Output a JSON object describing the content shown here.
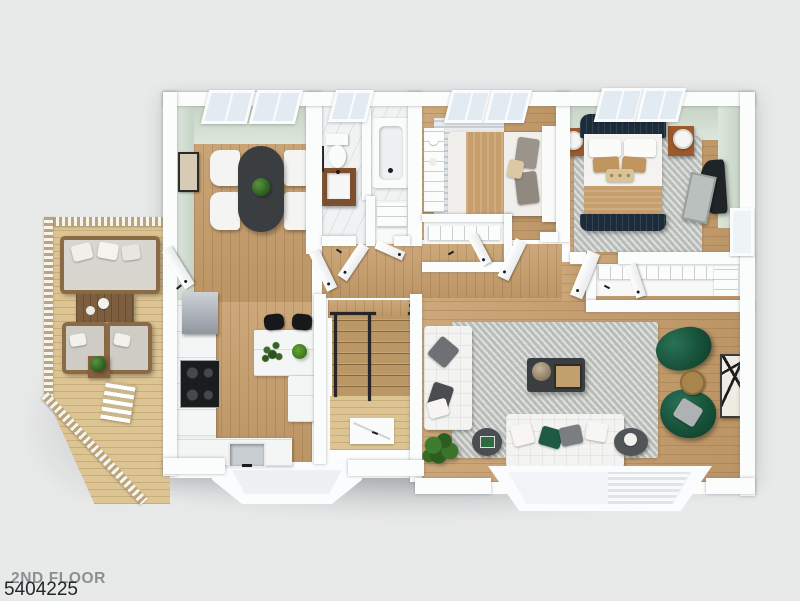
{
  "labels": {
    "floor_label": "2ND FLOOR",
    "watermark_id": "5404225"
  },
  "palette": {
    "background": "#e8e9e9",
    "wall": "#fbfcfc",
    "wood-floor": "#c79e6b",
    "deck-wood": "#ddc493",
    "sage-wall": "#ccd8cb",
    "marble": "#f0f2f3",
    "area-rug": "#c5c8c4",
    "navy-bed": "#1d2c3c",
    "tan-accent": "#c79f6c",
    "emerald-chair": "#175139",
    "dark-table": "#3a3e41",
    "plant-green": "#2f6322"
  },
  "floorplan": {
    "view": "3d-dollhouse-top-down",
    "floor_name": "2ND FLOOR",
    "rooms": [
      {
        "name": "deck",
        "floor": "light-wood",
        "furniture": [
          "outdoor-sofa",
          "outdoor-coffee-table",
          "outdoor-armchair",
          "outdoor-armchair",
          "plant-side-table",
          "deck-stairs"
        ]
      },
      {
        "name": "dining-room",
        "floor": "wood",
        "walls": "sage-green",
        "windows": 2,
        "furniture": [
          "oval-dining-table",
          "dining-chair",
          "dining-chair",
          "dining-chair",
          "dining-chair",
          "centerpiece-plant",
          "wall-art"
        ]
      },
      {
        "name": "kitchen",
        "floor": "wood",
        "furniture": [
          "counter-run",
          "range-hood",
          "cooktop",
          "sink",
          "island-peninsula",
          "bar-stool",
          "bar-stool",
          "counter-plants"
        ]
      },
      {
        "name": "bathroom",
        "floor": "marble",
        "windows": 1,
        "furniture": [
          "toilet",
          "wood-vanity-sink",
          "bathtub",
          "towel-bar",
          "linen-closet"
        ]
      },
      {
        "name": "bedroom-2",
        "floor": "wood",
        "windows": 2,
        "furniture": [
          "bed-tan-runner",
          "shelf-unit",
          "patterned-rug",
          "closet"
        ]
      },
      {
        "name": "master-bedroom",
        "floor": "wood",
        "walls": "sage-green",
        "windows": 3,
        "furniture": [
          "navy-upholstered-bed",
          "nightstand",
          "nightstand",
          "table-lamp",
          "table-lamp",
          "gray-rug",
          "dark-accent-chair",
          "leaning-mirror",
          "walk-in-closet"
        ]
      },
      {
        "name": "living-room",
        "floor": "wood",
        "furniture": [
          "white-sectional",
          "white-sofa",
          "dark-coffee-table",
          "serving-tray",
          "green-armchair",
          "green-armchair",
          "gold-side-table",
          "round-side-table",
          "round-side-table",
          "leaning-art",
          "floor-plant",
          "floor-lamp",
          "bay-window"
        ]
      },
      {
        "name": "hallway",
        "floor": "wood",
        "furniture": [
          "staircase",
          "stair-railing"
        ]
      }
    ]
  }
}
